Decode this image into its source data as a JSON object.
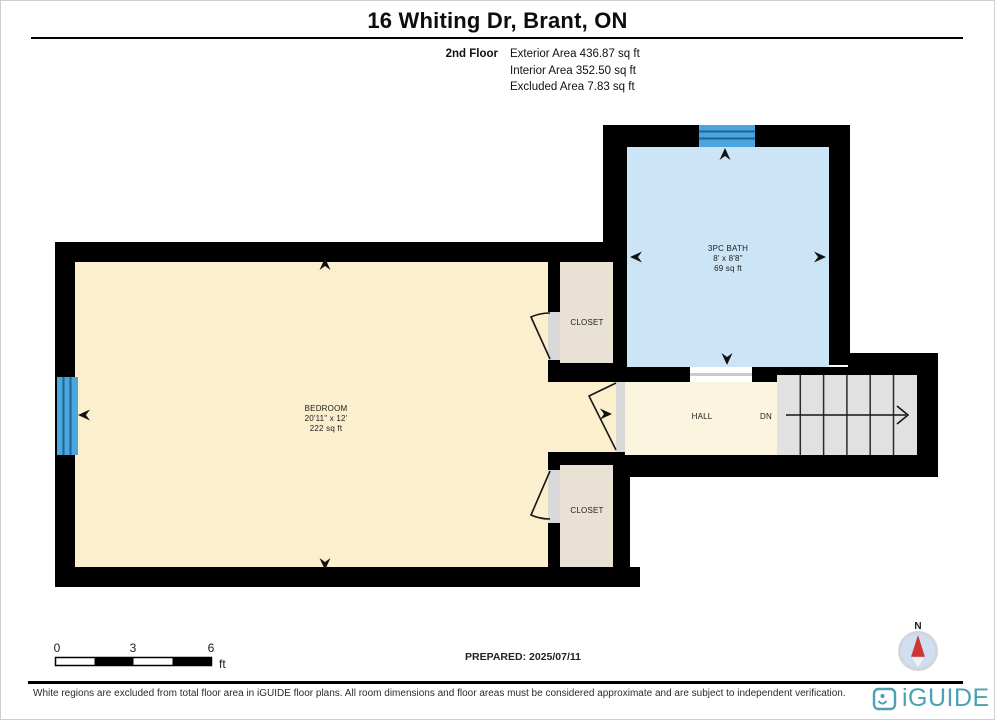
{
  "header": {
    "title": "16 Whiting Dr, Brant, ON",
    "floor_label": "2nd Floor",
    "stats": [
      "Exterior Area 436.87 sq ft",
      "Interior Area 352.50 sq ft",
      "Excluded Area 7.83 sq ft"
    ]
  },
  "plan": {
    "bath": {
      "name": "3PC BATH",
      "dims": "8' x 8'8\"",
      "area": "69 sq ft"
    },
    "bedroom": {
      "name": "BEDROOM",
      "dims": "20'11\" x 12'",
      "area": "222 sq ft"
    },
    "closet_upper": {
      "name": "CLOSET"
    },
    "closet_lower": {
      "name": "CLOSET"
    },
    "hall": {
      "name": "HALL"
    },
    "stairs": {
      "direction_label": "DN"
    }
  },
  "scale_bar": {
    "ticks": [
      "0",
      "3",
      "6"
    ],
    "unit": "ft"
  },
  "prepared_label": "PREPARED: 2025/07/11",
  "compass": {
    "north_label": "N"
  },
  "footer": {
    "disclaimer": "White regions are excluded from total floor area in iGUIDE floor plans. All room dimensions and floor areas must be considered approximate and are subject to independent verification.",
    "brand": "iGUIDE"
  },
  "colors": {
    "wall": "#000000",
    "bedroom_fill": "#fcefcd",
    "hall_fill": "#fbf5df",
    "bath_fill": "#cbe5f7",
    "closet_fill": "#e9e2d4",
    "stairs_fill": "#e1e1e1",
    "door_fill": "#d9d9d9",
    "window_blue": "#4aa6dd",
    "brand_teal": "#4ba1b5",
    "compass_red": "#d03434"
  }
}
